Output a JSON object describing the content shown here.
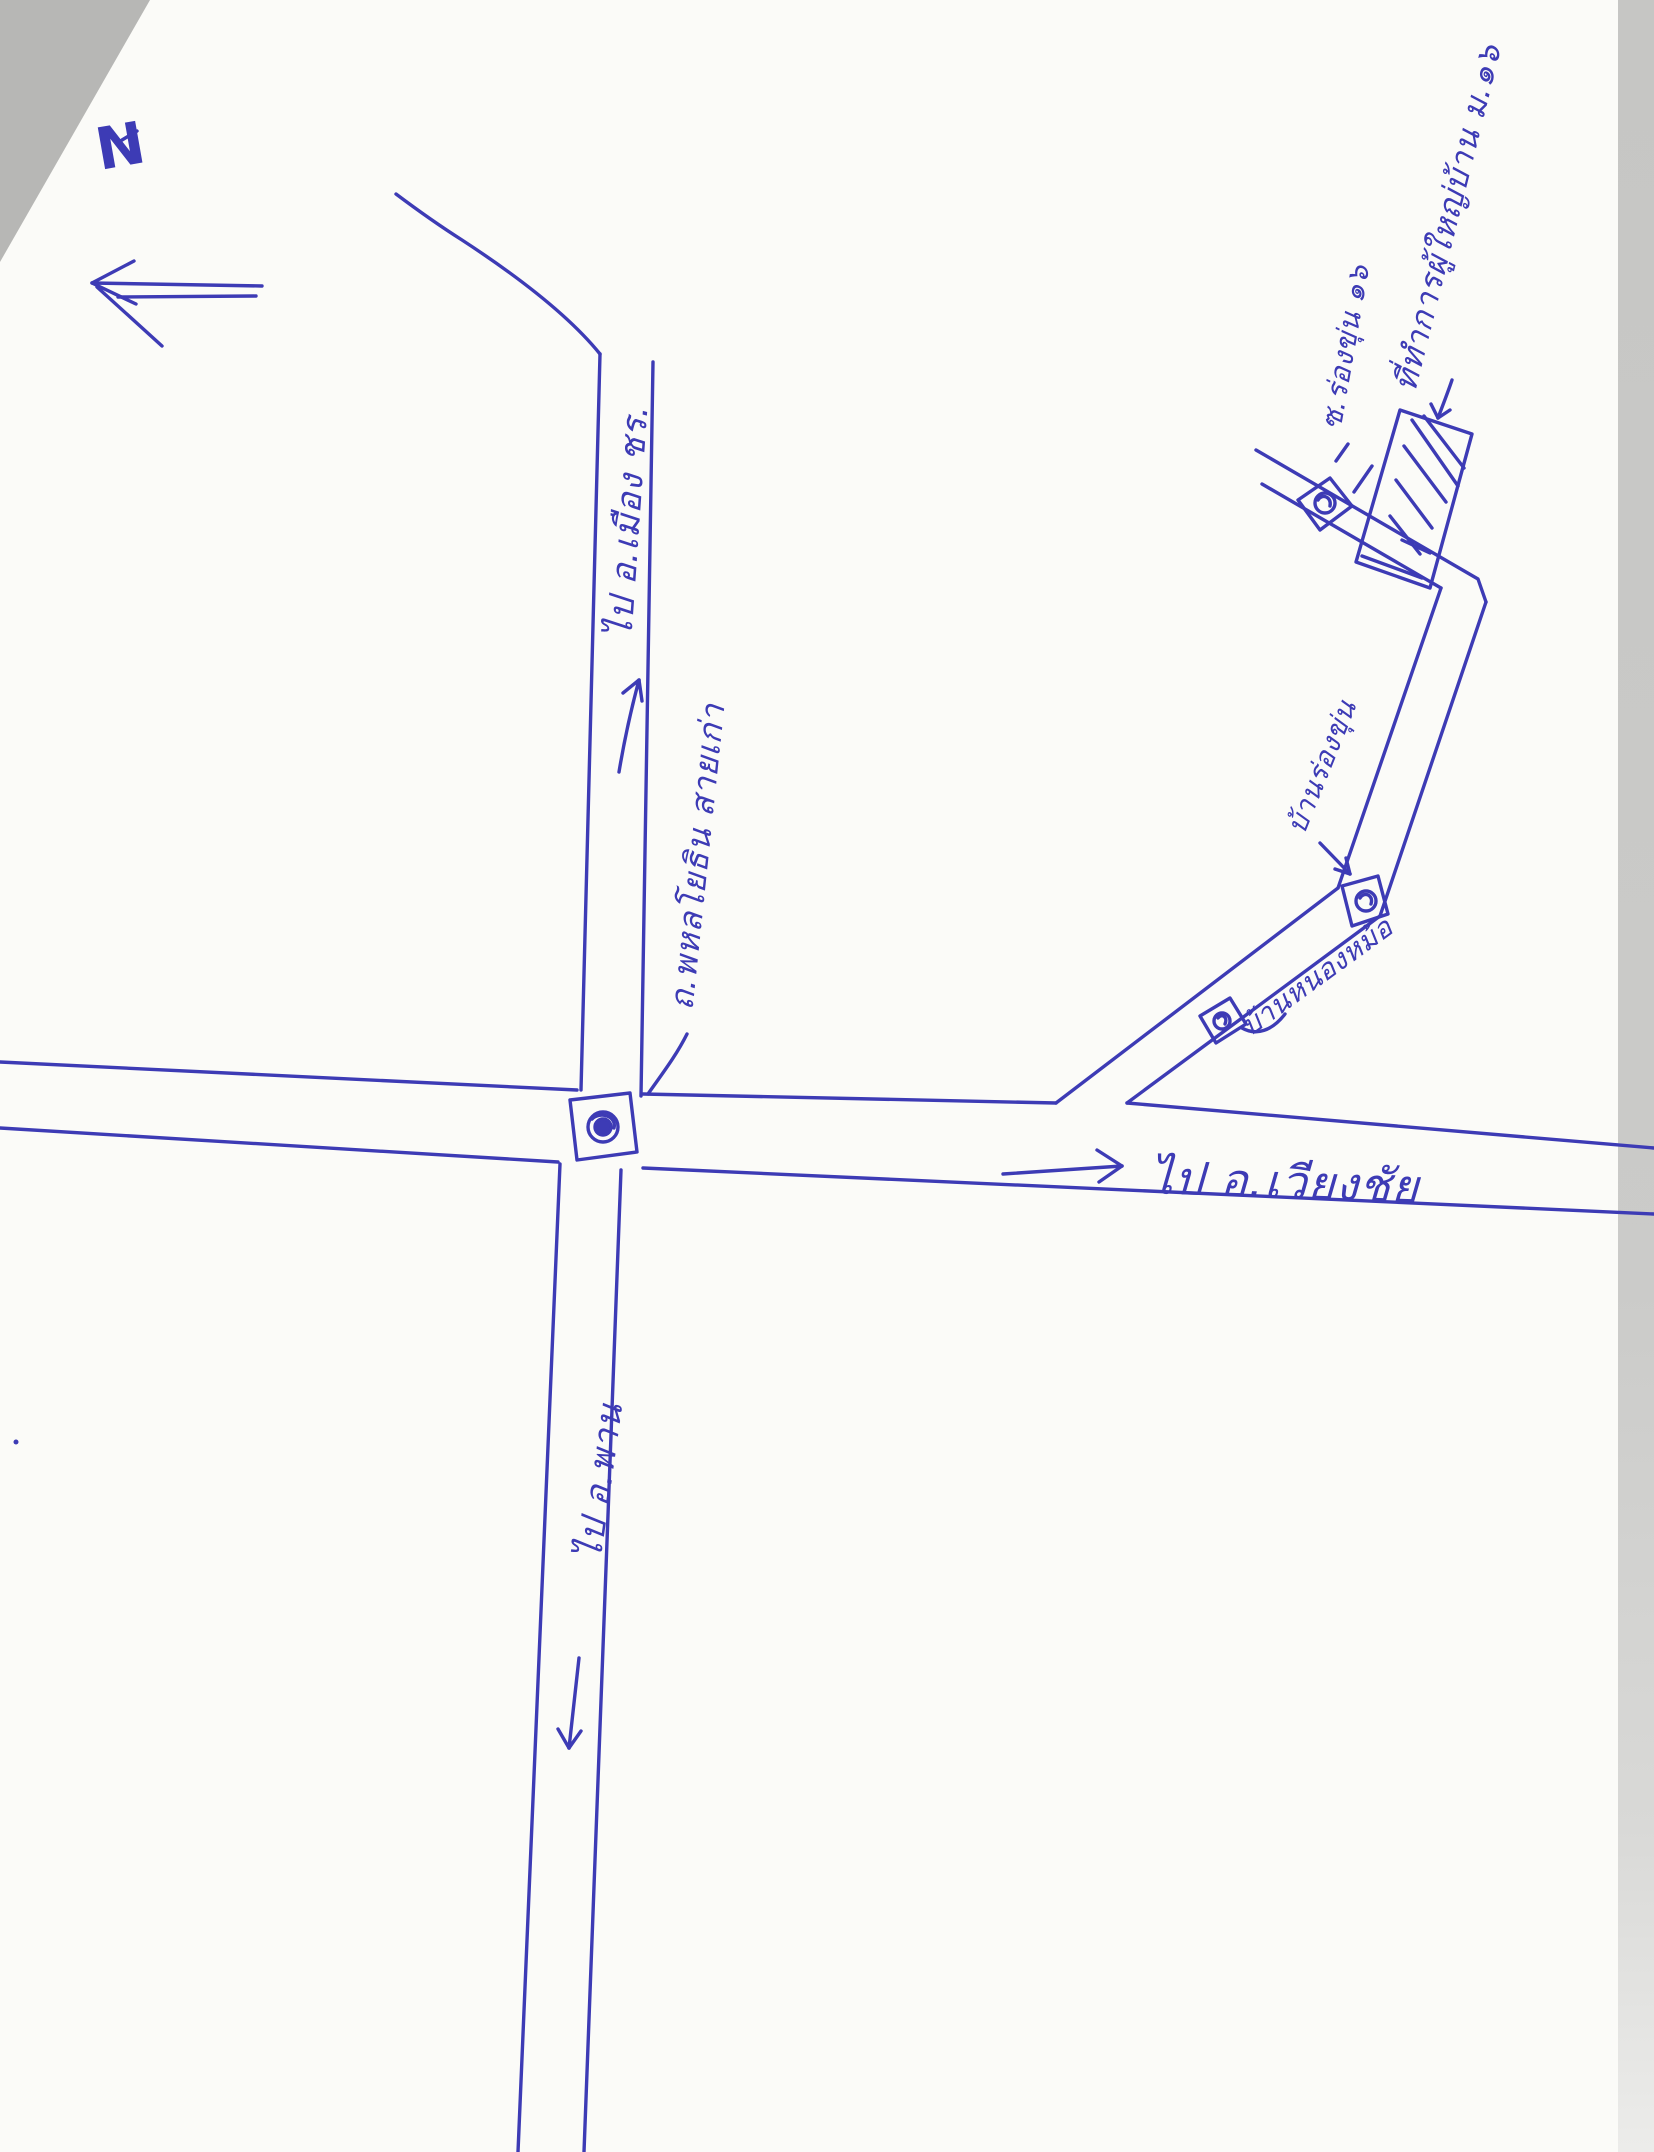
{
  "sheet": {
    "description": "hand-drawn route map in blue ballpoint pen on a scanned white page",
    "ink_color": "#3d3bb5",
    "paper_color": "#fbfbf8",
    "scan_edge_color": "#c6c6c4"
  },
  "compass": {
    "label": "N",
    "arrow_direction": "left"
  },
  "labels": {
    "to_mueang": "ไป อ.เมือง ชร.",
    "road_name": "ถ.พหลโยธิน สายเก่า",
    "to_phan": "ไป อ.พาน",
    "to_wiang_chai": "ไป อ.เวียงชัย",
    "ban_nong_mo": "บ้านหนองหม้อ",
    "ban_rong_khun": "บ้านร่องขุ่น",
    "soi": "ซ.ร่องขุ่น ๑๖",
    "destination": "ที่ทำการผู้ใหญ่บ้าน ม.๑๖"
  },
  "icons": {
    "north_arrow": "left-arrow",
    "travel_direction_main_north": "up-arrow",
    "travel_direction_main_south": "down-arrow",
    "travel_direction_east": "right-arrow",
    "traffic_light_symbol": "square-with-scribbled-circle",
    "destination_symbol": "hatched-rectangle"
  },
  "traffic_lights": [
    "central-crossroads",
    "branch-road-midway",
    "branch-road-bend",
    "near-destination"
  ]
}
